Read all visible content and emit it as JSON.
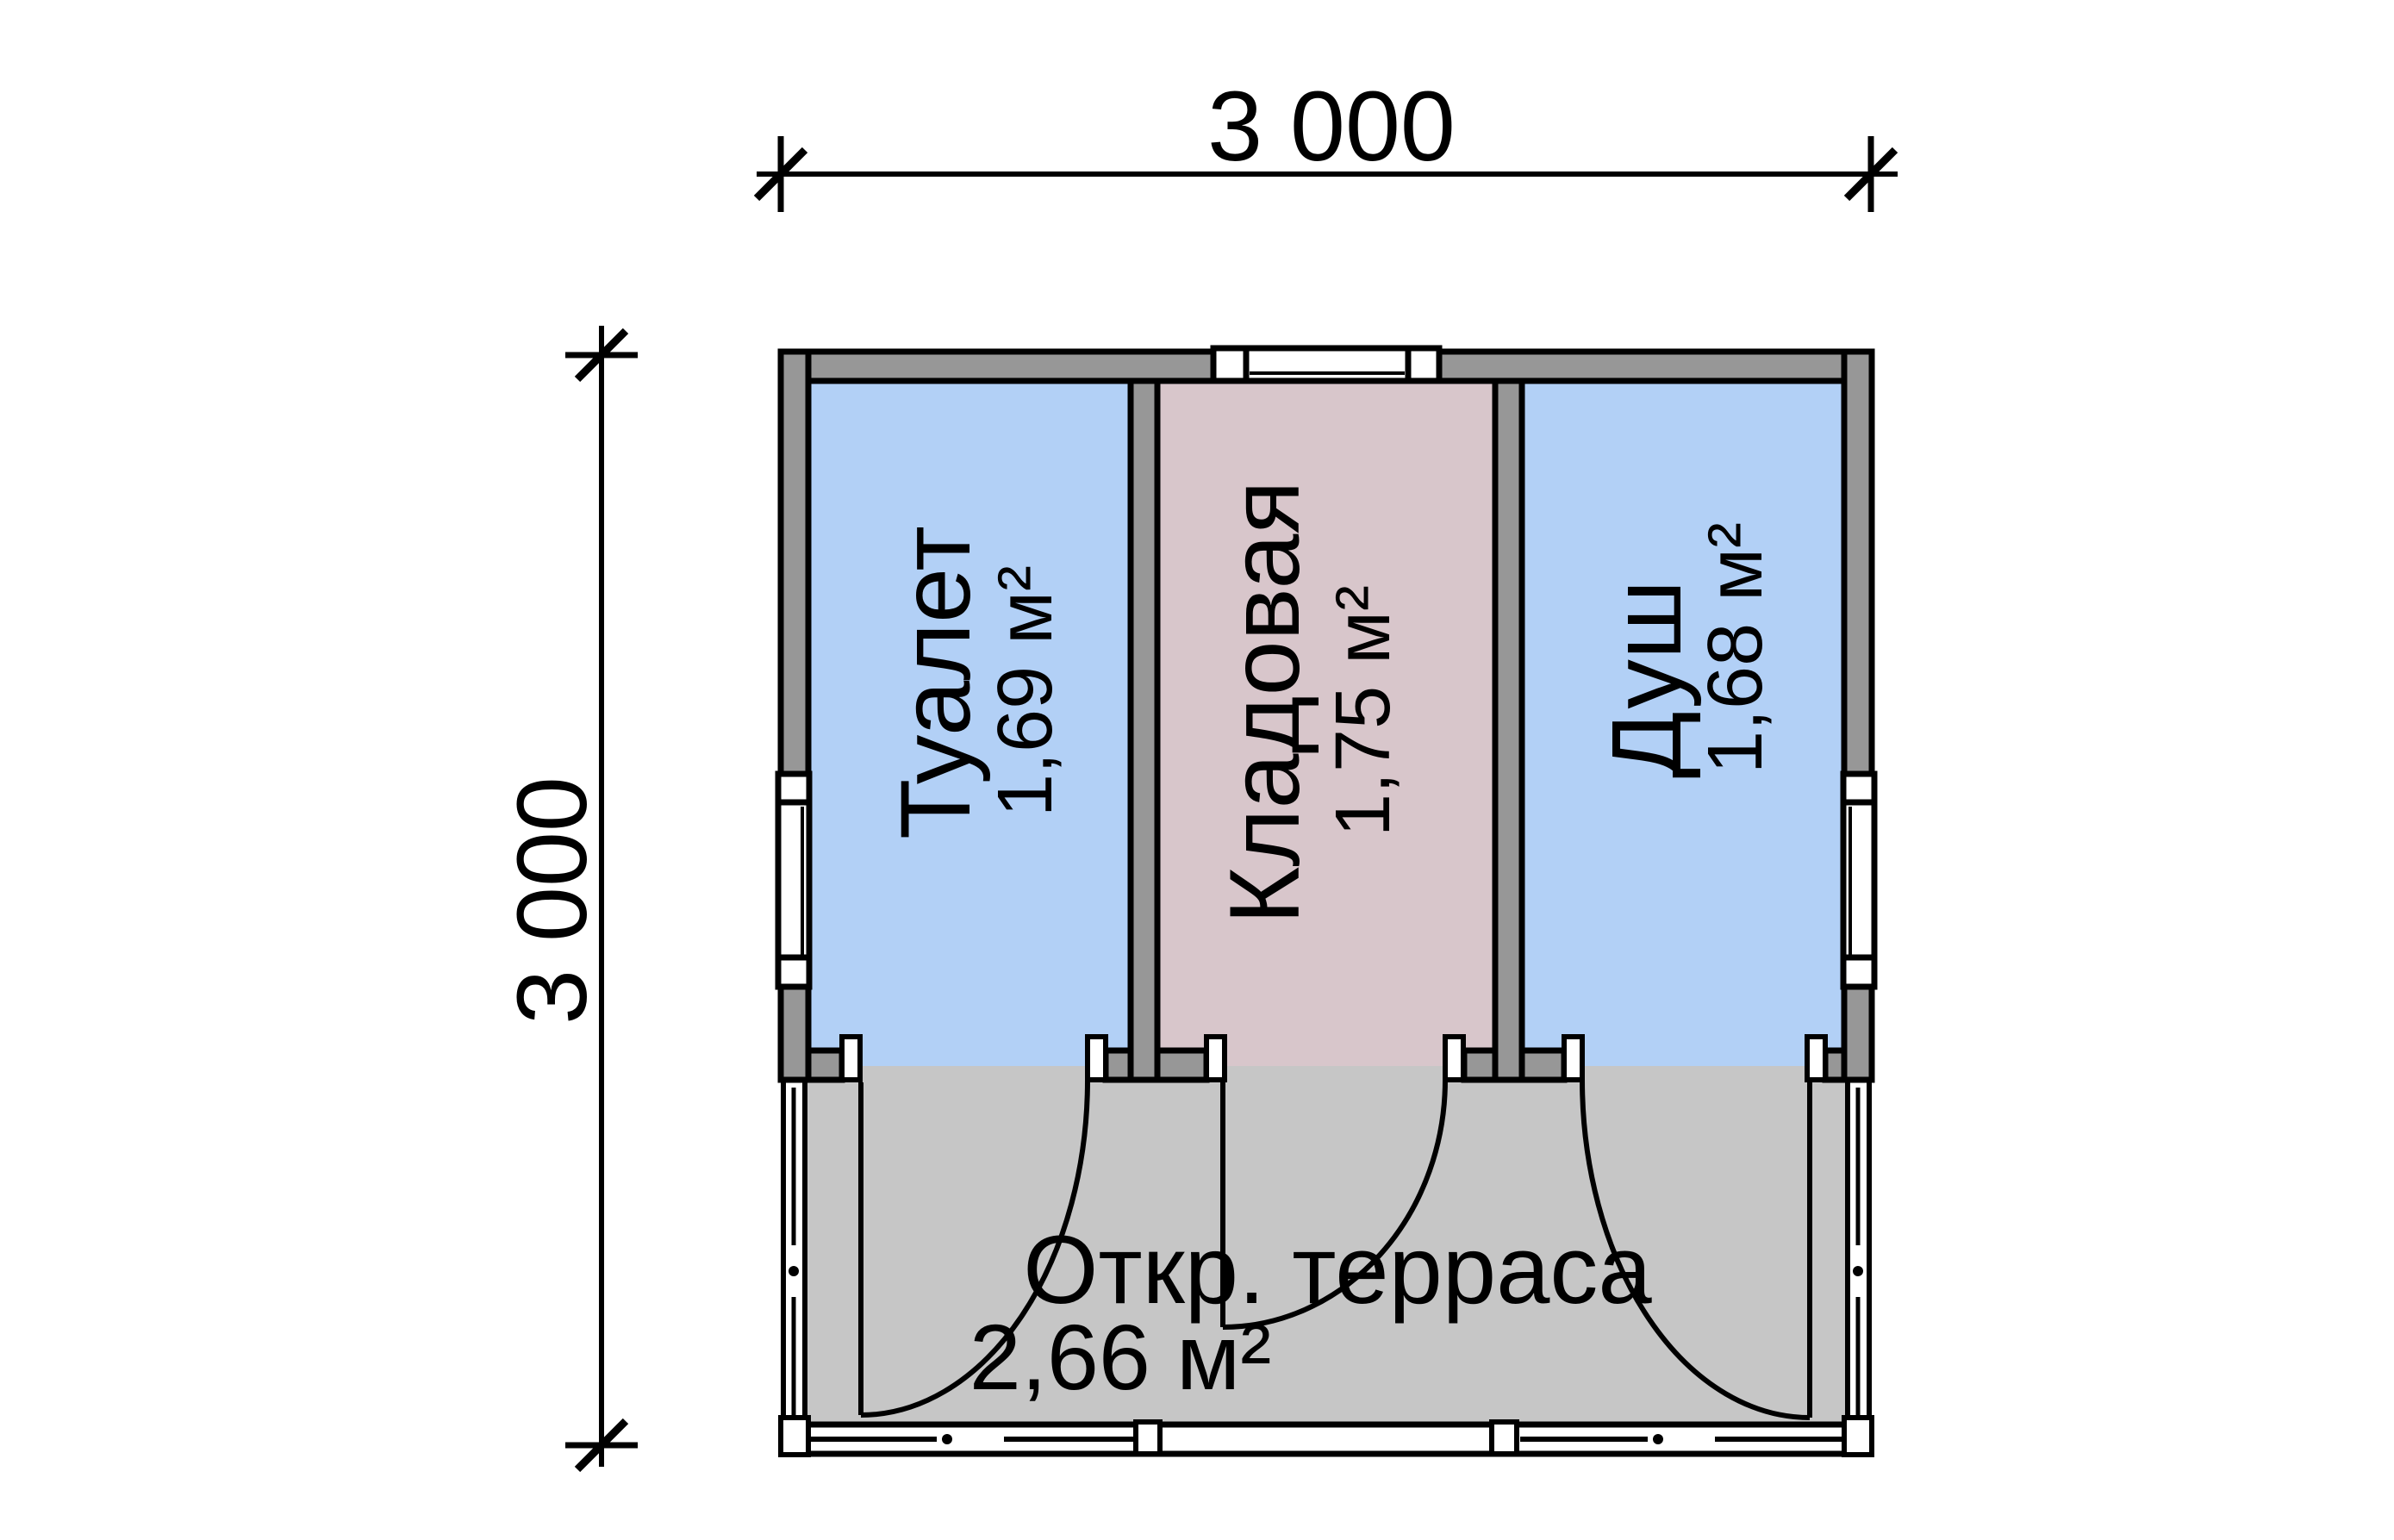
{
  "plan": {
    "dimensions": {
      "top": "3 000",
      "left": "3 000"
    },
    "rooms": [
      {
        "name": "Туалет",
        "area": "1,69 м²"
      },
      {
        "name": "Кладовая",
        "area": "1,75 м²"
      },
      {
        "name": "Душ",
        "area": "1,68 м²"
      },
      {
        "name": "Откр. терраса",
        "area": "2,66 м²"
      }
    ],
    "colors": {
      "wet_room_fill": "#b2d0f6",
      "storage_fill": "#d8c6cb",
      "terrace_fill": "#c6c6c6",
      "wall_fill": "#979797",
      "window_fill": "#ffffff",
      "line": "#000000",
      "background": "#ffffff"
    }
  }
}
